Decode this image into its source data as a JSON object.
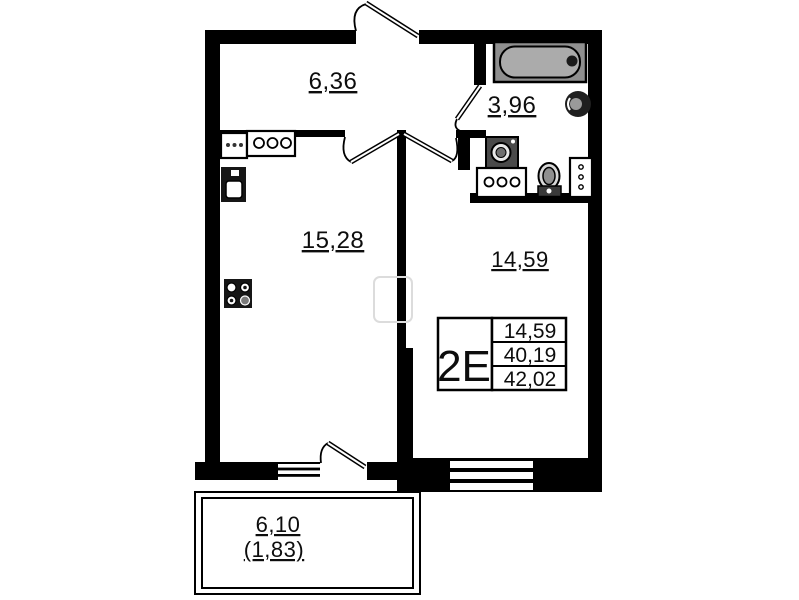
{
  "plan": {
    "unit_type": "2Е",
    "rooms": {
      "hallway": {
        "name": "hallway",
        "area": "6,36"
      },
      "bathroom": {
        "name": "bathroom",
        "area": "3,96"
      },
      "living": {
        "name": "living-kitchen",
        "area": "15,28"
      },
      "bedroom": {
        "name": "room",
        "area": "14,59"
      },
      "balcony": {
        "name": "balcony",
        "area": "6,10",
        "area_coeff": "(1,83)"
      }
    },
    "info_table": {
      "type": "2Е",
      "rows": [
        {
          "value": "14,59"
        },
        {
          "value": "40,19"
        },
        {
          "value": "42,02"
        }
      ]
    },
    "fixtures": [
      "bathtub",
      "round-sink",
      "washing-machine",
      "vanity-counter",
      "toilet",
      "bathroom-cabinet",
      "kitchen-counter",
      "kitchen-hob",
      "kitchen-sink",
      "stove"
    ],
    "colors": {
      "wall": "#000000",
      "tub_frame": "#8f8f8f",
      "tub": "#ababab",
      "appliance_dark": "#161616",
      "background": "#ffffff"
    }
  }
}
